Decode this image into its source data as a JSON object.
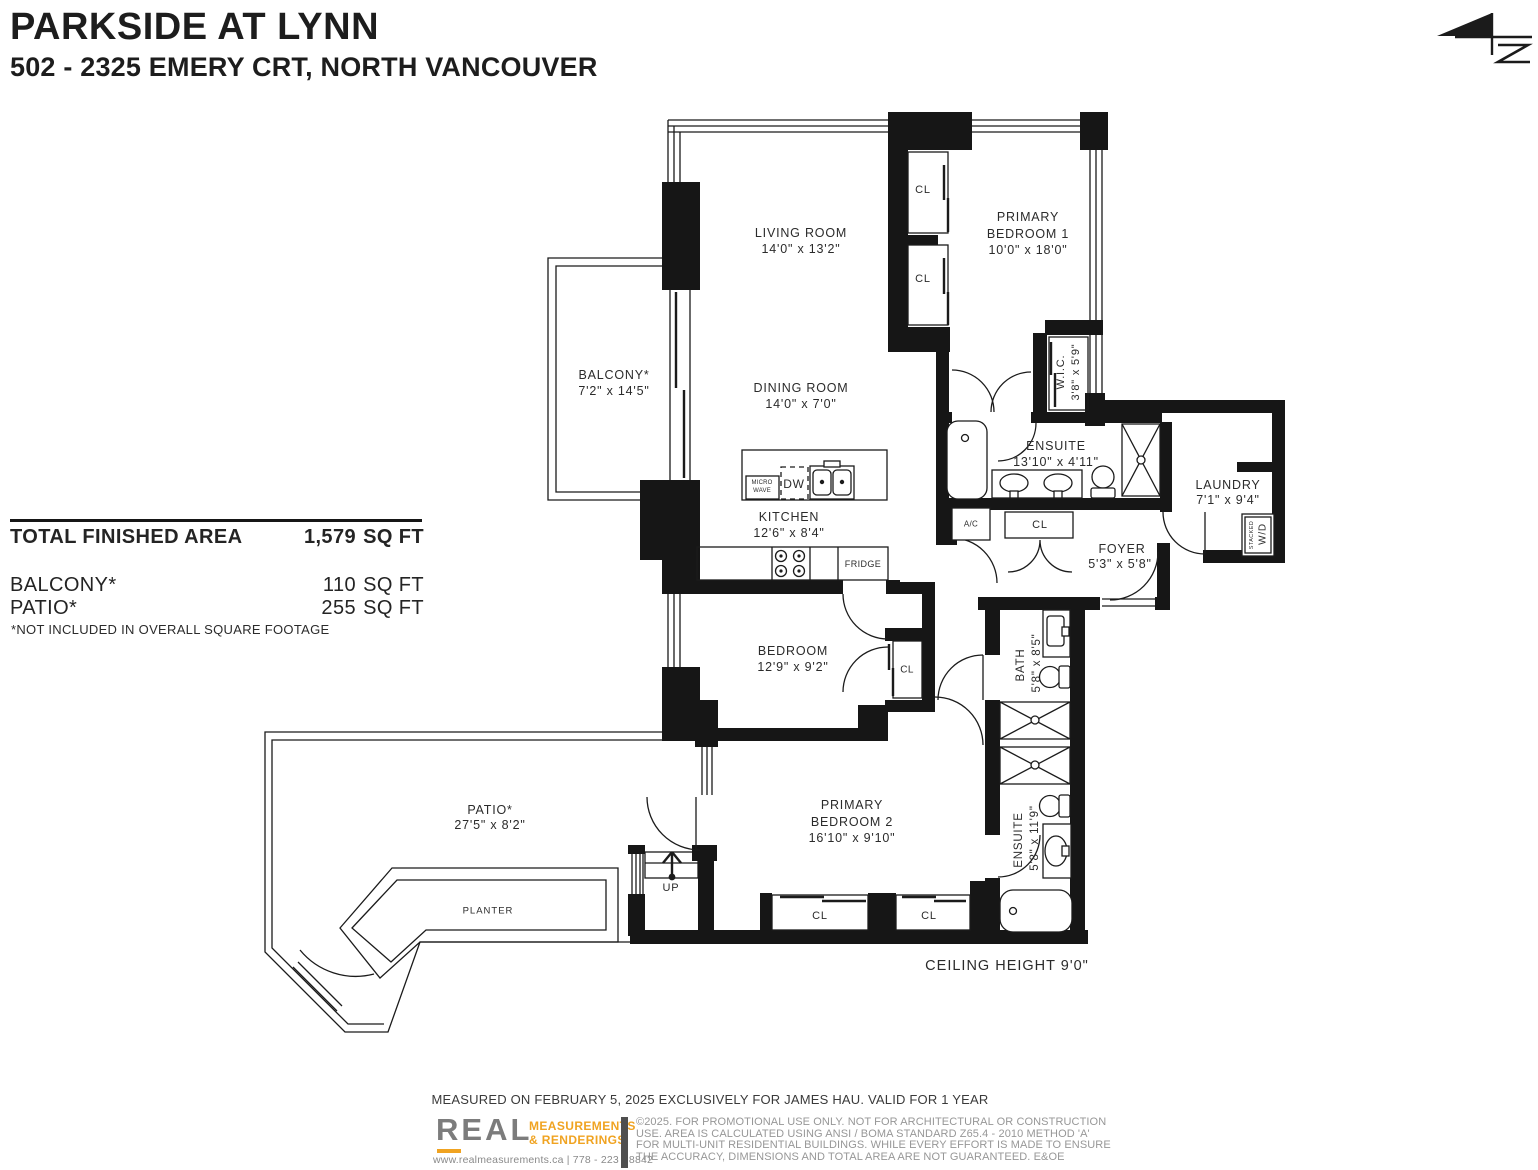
{
  "header": {
    "title": "PARKSIDE AT LYNN",
    "address": "502 - 2325 EMERY CRT, NORTH VANCOUVER"
  },
  "area_table": {
    "total_label": "TOTAL FINISHED AREA",
    "total_value": "1,579",
    "total_unit": "SQ FT",
    "balcony_label": "BALCONY*",
    "balcony_value": "110",
    "balcony_unit": "SQ FT",
    "patio_label": "PATIO*",
    "patio_value": "255",
    "patio_unit": "SQ FT",
    "note": "*NOT INCLUDED IN OVERALL SQUARE FOOTAGE"
  },
  "rooms": {
    "living": {
      "name": "LIVING ROOM",
      "dims": "14'0\" x 13'2\""
    },
    "dining": {
      "name": "DINING ROOM",
      "dims": "14'0\" x 7'0\""
    },
    "kitchen": {
      "name": "KITCHEN",
      "dims": "12'6\" x 8'4\""
    },
    "balcony": {
      "name": "BALCONY*",
      "dims": "7'2\" x 14'5\""
    },
    "primary1": {
      "line1": "PRIMARY",
      "line2": "BEDROOM 1",
      "dims": "10'0\" x 18'0\""
    },
    "wic": {
      "name": "W.I.C.",
      "dims": "3'8\" x 5'9\""
    },
    "ensuite1": {
      "name": "ENSUITE",
      "dims": "13'10\" x 4'11\""
    },
    "laundry": {
      "name": "LAUNDRY",
      "dims": "7'1\" x 9'4\""
    },
    "foyer": {
      "name": "FOYER",
      "dims": "5'3\" x 5'8\""
    },
    "bedroom": {
      "name": "BEDROOM",
      "dims": "12'9\" x 9'2\""
    },
    "bath": {
      "name": "BATH",
      "dims": "5'8\" x 8'5\""
    },
    "primary2": {
      "line1": "PRIMARY",
      "line2": "BEDROOM 2",
      "dims": "16'10\" x 9'10\""
    },
    "ensuite2": {
      "name": "ENSUITE",
      "dims": "5'8\" x 11'9\""
    },
    "patio": {
      "name": "PATIO*",
      "dims": "27'5\" x 8'2\""
    },
    "planter": "PLANTER"
  },
  "labels": {
    "cl": "CL",
    "ac": "A/C",
    "fridge": "FRIDGE",
    "dw": "DW",
    "micro_line1": "MICRO",
    "micro_line2": "WAVE",
    "stacked": "STACKED",
    "wd": "W/D",
    "up": "UP"
  },
  "notes": {
    "ceiling": "CEILING HEIGHT 9'0\""
  },
  "footer": {
    "measured": "MEASURED ON FEBRUARY 5, 2025 EXCLUSIVELY FOR JAMES HAU. VALID FOR 1 YEAR",
    "logo_text": "REAL",
    "logo_sub1": "MEASUREMENTS",
    "logo_sub2": "& RENDERINGS",
    "contact": "www.realmeasurements.ca | 778 - 223 - 8842",
    "disclaimer_line1": "©2025. FOR PROMOTIONAL USE ONLY. NOT FOR ARCHITECTURAL OR CONSTRUCTION",
    "disclaimer_line2": "USE. AREA IS CALCULATED USING ANSI / BOMA STANDARD Z65.4 - 2010 METHOD 'A'",
    "disclaimer_line3": "FOR MULTI-UNIT RESIDENTIAL BUILDINGS. WHILE EVERY EFFORT IS MADE TO ENSURE",
    "disclaimer_line4": "THE ACCURACY, DIMENSIONS AND TOTAL AREA ARE NOT GUARANTEED. E&OE"
  },
  "colors": {
    "ink": "#161616",
    "grey": "#8a8a8a",
    "orange": "#f0a321",
    "logo_grey": "#7c7c7c"
  }
}
